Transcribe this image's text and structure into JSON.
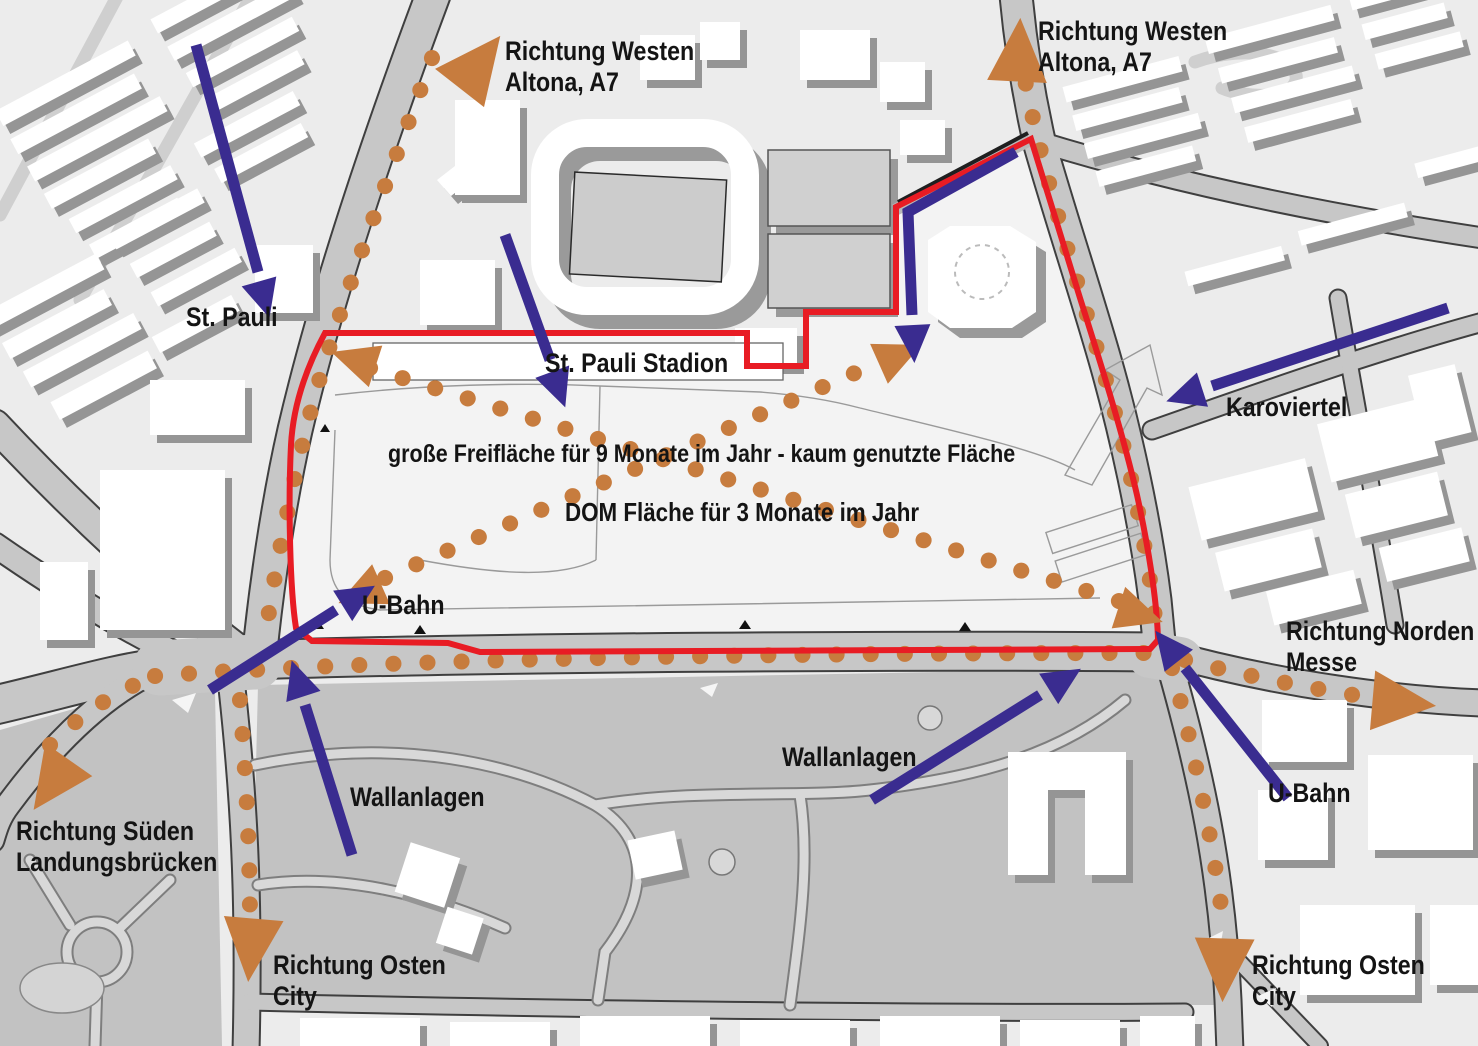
{
  "map": {
    "labels": {
      "rw_left_1": "Richtung Westen",
      "rw_left_2": "Altona, A7",
      "rw_right_1": "Richtung Westen",
      "rw_right_2": "Altona, A7",
      "st_pauli": "St. Pauli",
      "stadion": "St. Pauli Stadion",
      "karoviertel": "Karoviertel",
      "freiflaeche": "große  Freifläche für 9 Monate im Jahr - kaum genutzte Fläche",
      "dom": "DOM Fläche für 3 Monate im Jahr",
      "ubahn_left": "U-Bahn",
      "ubahn_right": "U-Bahn",
      "norden_1": "Richtung Norden",
      "norden_2": "Messe",
      "wall_center": "Wallanlagen",
      "wall_left": "Wallanlagen",
      "sueden_1": "Richtung Süden",
      "sueden_2": "Landungsbrücken",
      "osten_left_1": "Richtung Osten",
      "osten_left_2": "City",
      "osten_right_1": "Richtung Osten",
      "osten_right_2": "City"
    },
    "colors": {
      "route_dotted": "#c77c3e",
      "direction_arrow": "#c77c3e",
      "flow_arrow": "#3a2c90",
      "boundary": "#e81c24"
    }
  }
}
